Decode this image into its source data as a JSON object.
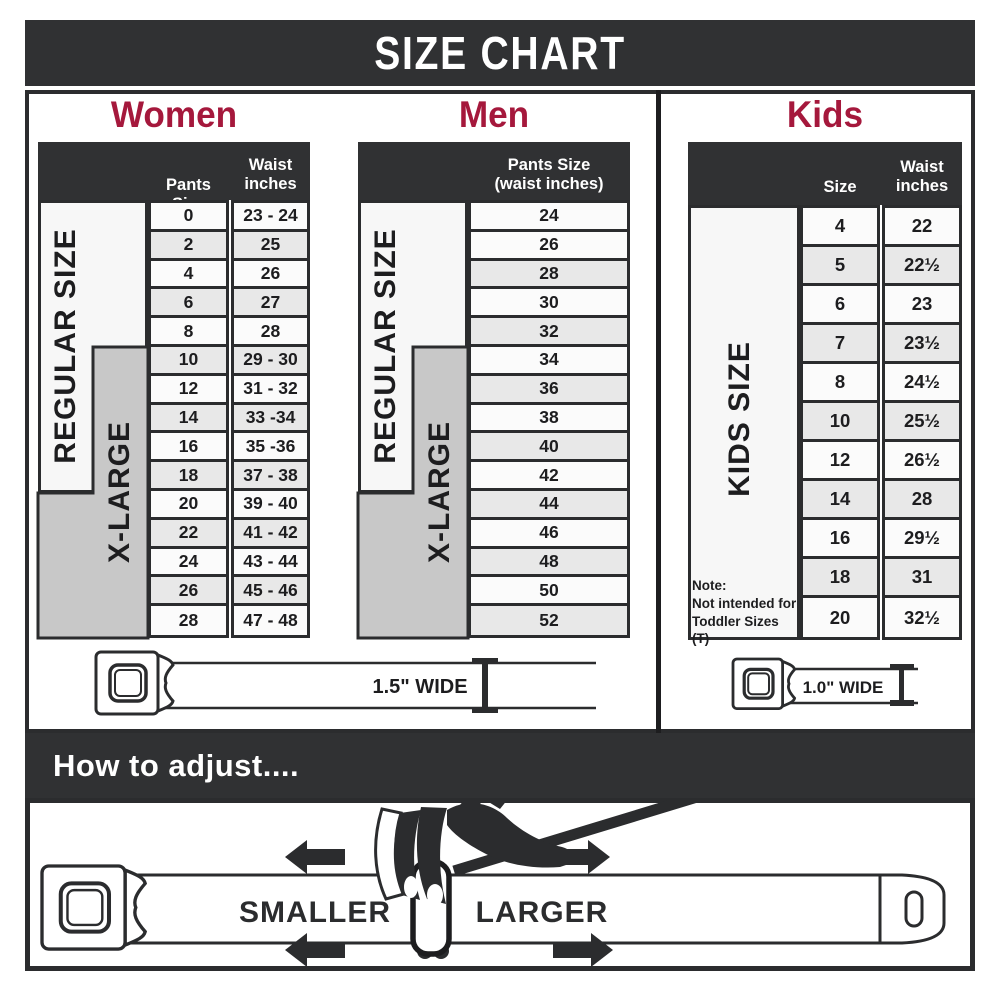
{
  "title": "SIZE CHART",
  "colors": {
    "accent": "#a5183c",
    "dark": "#303133",
    "line": "#2b2c2e"
  },
  "women": {
    "title": "Women",
    "pants_header": "Pants Size",
    "waist_header": "Waist\ninches",
    "regular_label": "REGULAR SIZE",
    "xlarge_label": "X-LARGE",
    "rows": [
      {
        "size": "0",
        "waist": "23 - 24"
      },
      {
        "size": "2",
        "waist": "25"
      },
      {
        "size": "4",
        "waist": "26"
      },
      {
        "size": "6",
        "waist": "27"
      },
      {
        "size": "8",
        "waist": "28"
      },
      {
        "size": "10",
        "waist": "29 - 30"
      },
      {
        "size": "12",
        "waist": "31 - 32"
      },
      {
        "size": "14",
        "waist": "33 -34"
      },
      {
        "size": "16",
        "waist": "35 -36"
      },
      {
        "size": "18",
        "waist": "37 - 38"
      },
      {
        "size": "20",
        "waist": "39 - 40"
      },
      {
        "size": "22",
        "waist": "41 - 42"
      },
      {
        "size": "24",
        "waist": "43 - 44"
      },
      {
        "size": "26",
        "waist": "45 - 46"
      },
      {
        "size": "28",
        "waist": "47 - 48"
      }
    ]
  },
  "men": {
    "title": "Men",
    "header": "Pants Size\n(waist inches)",
    "regular_label": "REGULAR SIZE",
    "xlarge_label": "X-LARGE",
    "rows": [
      "24",
      "26",
      "28",
      "30",
      "32",
      "34",
      "36",
      "38",
      "40",
      "42",
      "44",
      "46",
      "48",
      "50",
      "52"
    ]
  },
  "kids": {
    "title": "Kids",
    "size_header": "Size",
    "waist_header": "Waist\ninches",
    "side_label": "KIDS SIZE",
    "note": "Note:\nNot intended for\nToddler Sizes (T)",
    "rows": [
      {
        "size": "4",
        "waist": "22"
      },
      {
        "size": "5",
        "waist": "22½"
      },
      {
        "size": "6",
        "waist": "23"
      },
      {
        "size": "7",
        "waist": "23½"
      },
      {
        "size": "8",
        "waist": "24½"
      },
      {
        "size": "10",
        "waist": "25½"
      },
      {
        "size": "12",
        "waist": "26½"
      },
      {
        "size": "14",
        "waist": "28"
      },
      {
        "size": "16",
        "waist": "29½"
      },
      {
        "size": "18",
        "waist": "31"
      },
      {
        "size": "20",
        "waist": "32½"
      }
    ]
  },
  "belts": {
    "adult_width_label": "1.5\" WIDE",
    "kids_width_label": "1.0\" WIDE"
  },
  "adjust": {
    "title": "How to adjust....",
    "smaller_label": "SMALLER",
    "larger_label": "LARGER"
  }
}
